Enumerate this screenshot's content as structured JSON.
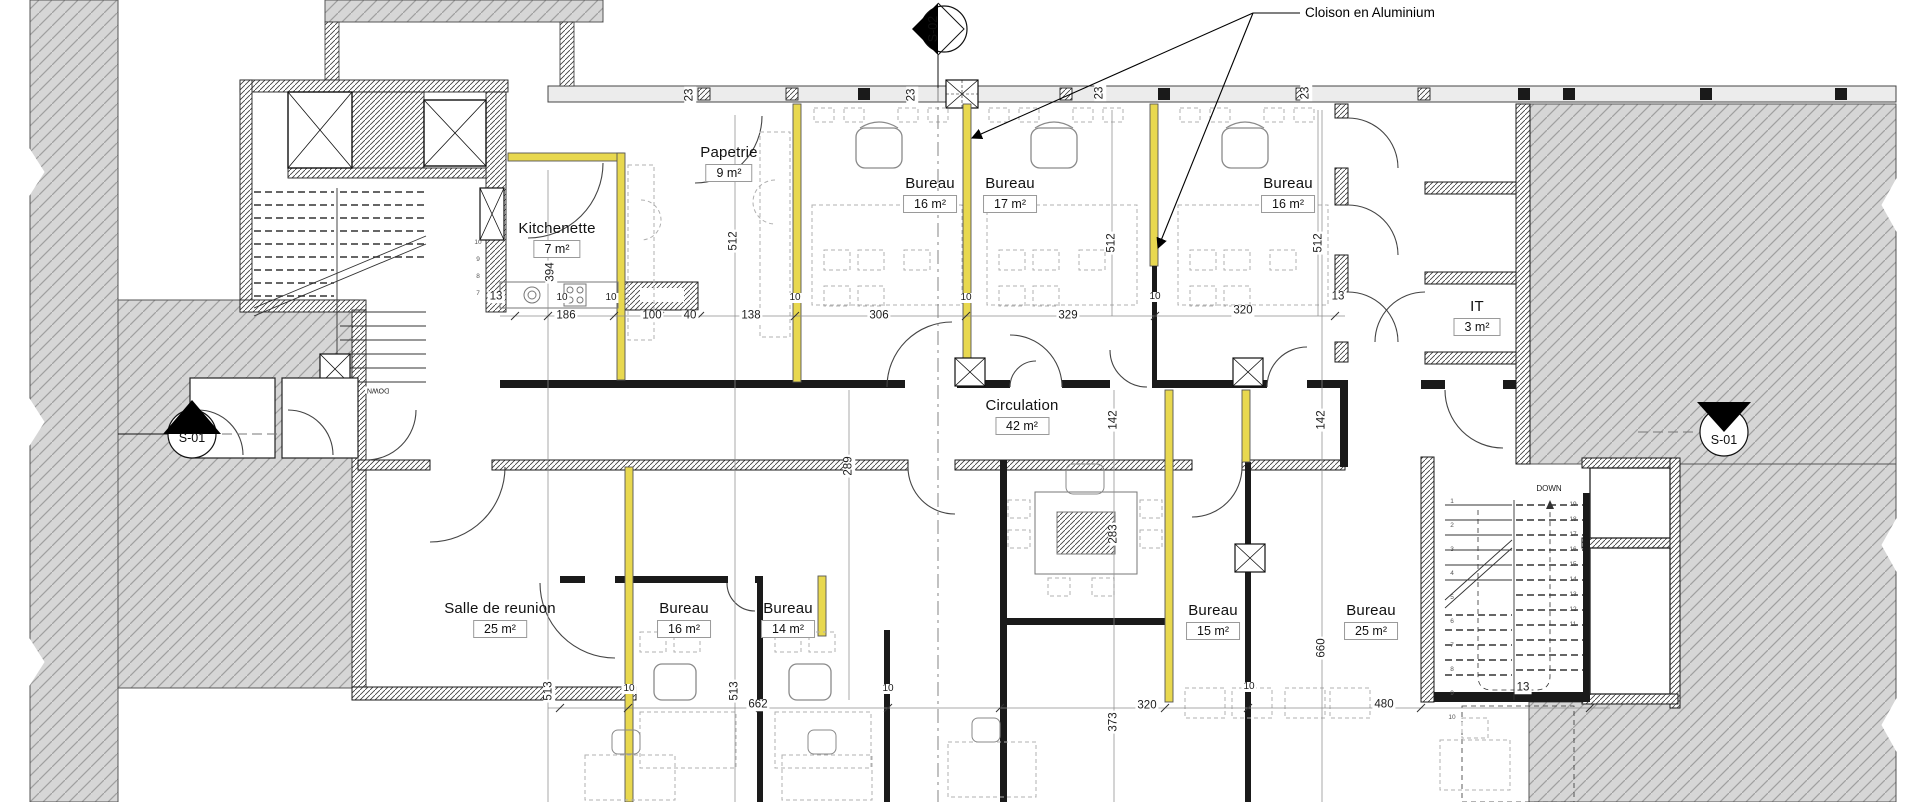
{
  "drawing": {
    "callout": {
      "partition_note": "Cloison en Aluminium"
    },
    "markers": {
      "top": "S-02",
      "left": "S-01",
      "right": "S-01"
    },
    "rooms": [
      {
        "id": "papeterie",
        "name": "Papetrie",
        "area": "9 m²"
      },
      {
        "id": "kitchenette",
        "name": "Kitchenette",
        "area": "7 m²"
      },
      {
        "id": "bureau-a",
        "name": "Bureau",
        "area": "16 m²"
      },
      {
        "id": "bureau-b",
        "name": "Bureau",
        "area": "17 m²"
      },
      {
        "id": "bureau-c",
        "name": "Bureau",
        "area": "16 m²"
      },
      {
        "id": "it-room",
        "name": "IT",
        "area": "3 m²"
      },
      {
        "id": "circulation",
        "name": "Circulation",
        "area": "42 m²"
      },
      {
        "id": "salle",
        "name": "Salle de reunion",
        "area": "25 m²"
      },
      {
        "id": "bureau-d",
        "name": "Bureau",
        "area": "16 m²"
      },
      {
        "id": "bureau-e",
        "name": "Bureau",
        "area": "14 m²"
      },
      {
        "id": "bureau-f",
        "name": "Bureau",
        "area": "15 m²"
      },
      {
        "id": "bureau-g",
        "name": "Bureau",
        "area": "25 m²"
      }
    ],
    "dimensions": [
      {
        "t": "23",
        "x": 690,
        "y": 95,
        "r": -90
      },
      {
        "t": "23",
        "x": 912,
        "y": 95,
        "r": -90
      },
      {
        "t": "23",
        "x": 1100,
        "y": 93,
        "r": -90
      },
      {
        "t": "23",
        "x": 1306,
        "y": 93,
        "r": -90
      },
      {
        "t": "13",
        "x": 496,
        "y": 297
      },
      {
        "t": "186",
        "x": 566,
        "y": 316
      },
      {
        "t": "10",
        "x": 562,
        "y": 298,
        "s": 10
      },
      {
        "t": "10",
        "x": 611,
        "y": 298,
        "s": 10
      },
      {
        "t": "100",
        "x": 652,
        "y": 316
      },
      {
        "t": "40",
        "x": 690,
        "y": 316
      },
      {
        "t": "138",
        "x": 751,
        "y": 316
      },
      {
        "t": "10",
        "x": 795,
        "y": 298,
        "s": 10
      },
      {
        "t": "306",
        "x": 879,
        "y": 316
      },
      {
        "t": "10",
        "x": 966,
        "y": 298,
        "s": 10
      },
      {
        "t": "329",
        "x": 1068,
        "y": 316
      },
      {
        "t": "10",
        "x": 1155,
        "y": 297,
        "s": 10
      },
      {
        "t": "320",
        "x": 1243,
        "y": 311
      },
      {
        "t": "13",
        "x": 1338,
        "y": 297
      },
      {
        "t": "394",
        "x": 551,
        "y": 272,
        "r": -90
      },
      {
        "t": "512",
        "x": 734,
        "y": 241,
        "r": -90
      },
      {
        "t": "512",
        "x": 1112,
        "y": 243,
        "r": -90
      },
      {
        "t": "512",
        "x": 1319,
        "y": 243,
        "r": -90
      },
      {
        "t": "142",
        "x": 1114,
        "y": 420,
        "r": -90
      },
      {
        "t": "142",
        "x": 1322,
        "y": 420,
        "r": -90
      },
      {
        "t": "289",
        "x": 849,
        "y": 466,
        "r": -90
      },
      {
        "t": "283",
        "x": 1114,
        "y": 534,
        "r": -90
      },
      {
        "t": "513",
        "x": 549,
        "y": 691,
        "r": -90
      },
      {
        "t": "513",
        "x": 735,
        "y": 691,
        "r": -90
      },
      {
        "t": "660",
        "x": 1322,
        "y": 648,
        "r": -90
      },
      {
        "t": "373",
        "x": 1114,
        "y": 722,
        "r": -90
      },
      {
        "t": "662",
        "x": 758,
        "y": 705
      },
      {
        "t": "10",
        "x": 629,
        "y": 689,
        "s": 10
      },
      {
        "t": "10",
        "x": 888,
        "y": 689,
        "s": 10
      },
      {
        "t": "10",
        "x": 1249,
        "y": 687,
        "s": 10
      },
      {
        "t": "320",
        "x": 1147,
        "y": 706
      },
      {
        "t": "480",
        "x": 1384,
        "y": 705
      },
      {
        "t": "13",
        "x": 1523,
        "y": 688
      },
      {
        "t": "DOWN",
        "x": 378,
        "y": 390,
        "r": 180,
        "s": 7
      },
      {
        "t": "DOWN",
        "x": 1549,
        "y": 489,
        "s": 8
      }
    ],
    "stair_number_groups": [
      {
        "x": 478,
        "y0": 243,
        "dy": 17,
        "items": [
          "10",
          "9",
          "8",
          "7"
        ]
      },
      {
        "x": 1452,
        "y0": 502,
        "dy": 24,
        "items": [
          "1",
          "2",
          "3",
          "4",
          "5",
          "6",
          "7",
          "8",
          "9",
          "10"
        ]
      },
      {
        "x": 1573,
        "y0": 505,
        "dy": 15,
        "items": [
          "19",
          "18",
          "17",
          "16",
          "15",
          "14",
          "13",
          "12",
          "11"
        ]
      }
    ],
    "colors": {
      "partition_yellow": "#e8d84f",
      "poche_gray": "#d6d6d6",
      "wall_black": "#1a1a1a"
    }
  }
}
